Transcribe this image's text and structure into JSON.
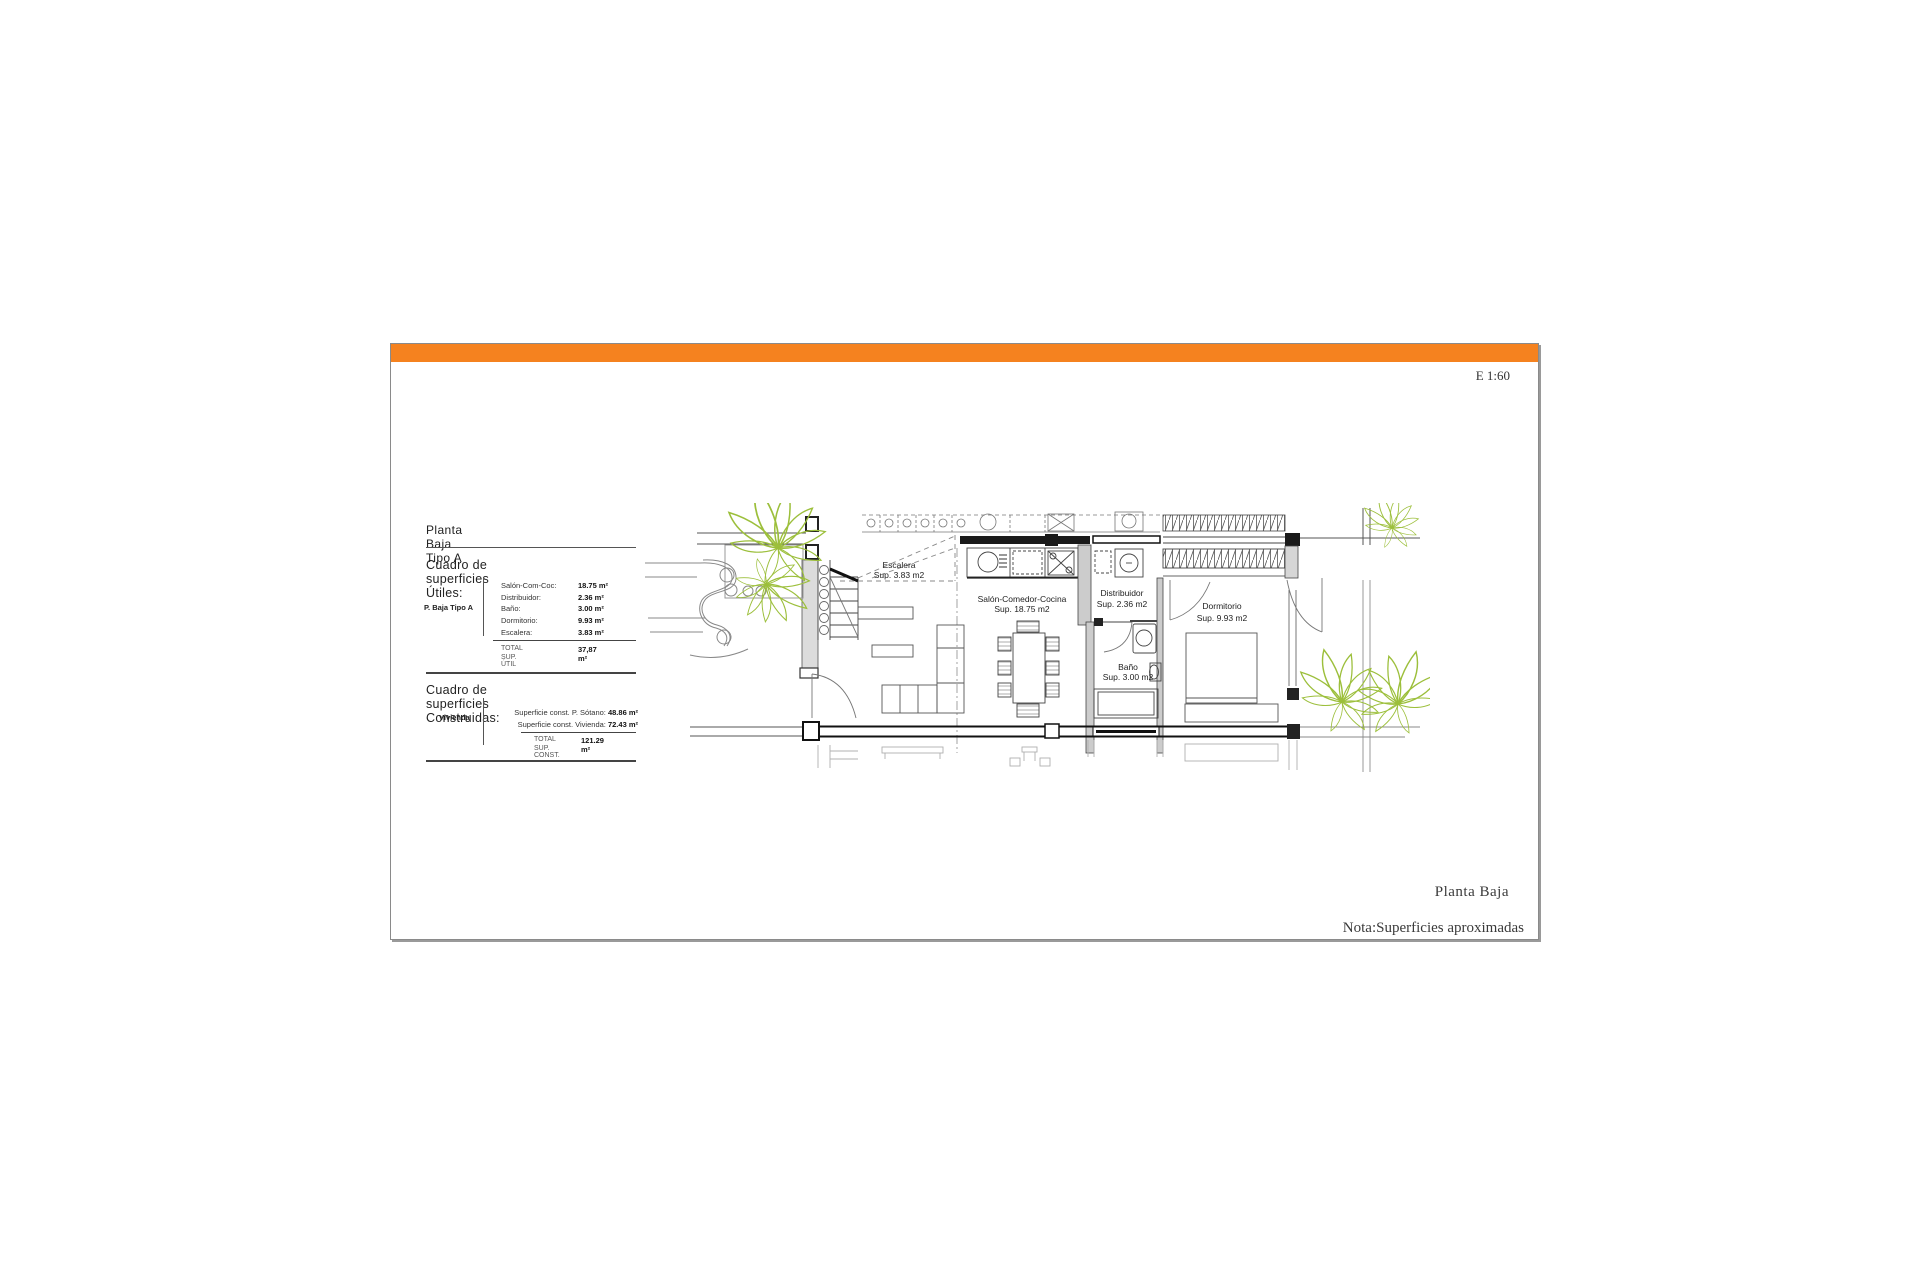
{
  "page": {
    "scale_label": "E 1:60",
    "footer_title": "Planta Baja",
    "footer_note": "Nota:Superficies aproximadas",
    "accent_color": "#F5821F",
    "plant_color": "#9cbf3b"
  },
  "summary": {
    "title": "Planta Baja Tipo A",
    "utiles": {
      "heading": "Cuadro de superficies Útiles:",
      "row_label": "P. Baja Tipo A",
      "rows": [
        {
          "label": "Salón-Com-Coc:",
          "value": "18.75 m²"
        },
        {
          "label": "Distribuidor:",
          "value": "2.36 m²"
        },
        {
          "label": "Baño:",
          "value": "3.00 m²"
        },
        {
          "label": "Dormitorio:",
          "value": "9.93 m²"
        },
        {
          "label": "Escalera:",
          "value": "3.83 m²"
        }
      ],
      "total_label_1": "TOTAL",
      "total_label_2": "SUP. ÚTIL",
      "total_value": "37,87 m²"
    },
    "construidas": {
      "heading": "Cuadro de superficies Construidas:",
      "row_label": "Vivienda",
      "rows": [
        {
          "label": "Superficie const. P. Sótano: ",
          "value": "48.86 m²"
        },
        {
          "label": "Superficie const. Vivienda: ",
          "value": "72.43 m²"
        }
      ],
      "total_label_1": "TOTAL",
      "total_label_2": "SUP. CONST.",
      "total_value": "121.29 m²"
    }
  },
  "plan": {
    "rooms": [
      {
        "name": "Escalera",
        "sup": "Sup. 3.83 m2"
      },
      {
        "name": "Salón-Comedor-Cocina",
        "sup": "Sup. 18.75 m2"
      },
      {
        "name": "Distribuidor",
        "sup": "Sup. 2.36 m2"
      },
      {
        "name": "Dormitorio",
        "sup": "Sup. 9.93 m2"
      },
      {
        "name": "Baño",
        "sup": "Sup. 3.00 m2"
      }
    ]
  }
}
